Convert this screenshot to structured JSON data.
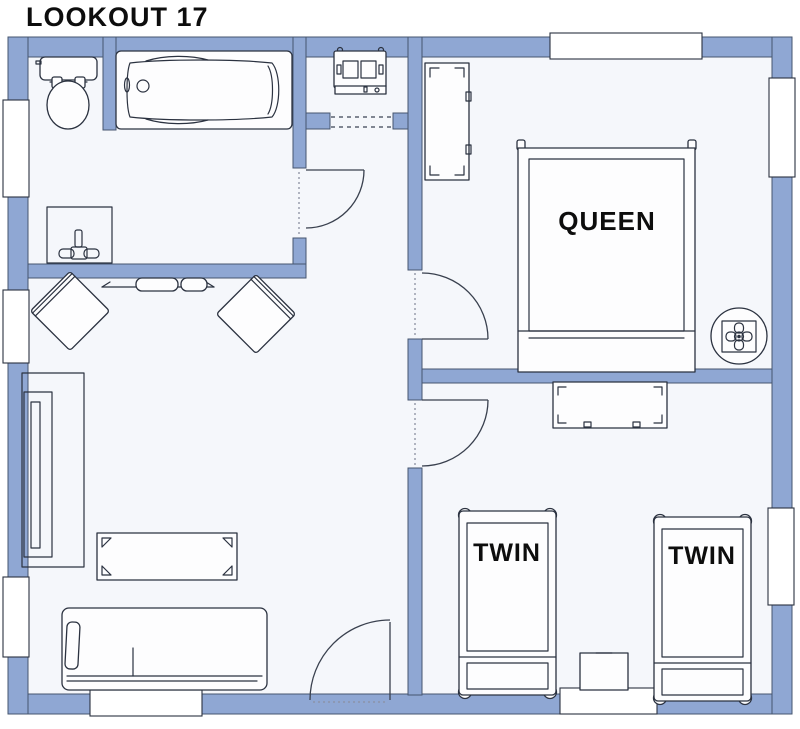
{
  "title": "LOOKOUT 17",
  "labels": {
    "queen_bed": "QUEEN",
    "twin_bed_left": "TWIN",
    "twin_bed_right": "TWIN"
  },
  "colors": {
    "wall": "#8fa7d3",
    "wall-border": "#46566f",
    "line": "#2b3240",
    "floor": "#f5f7fb",
    "page-bg": "#ffffff",
    "label": "#0d0d0d"
  }
}
